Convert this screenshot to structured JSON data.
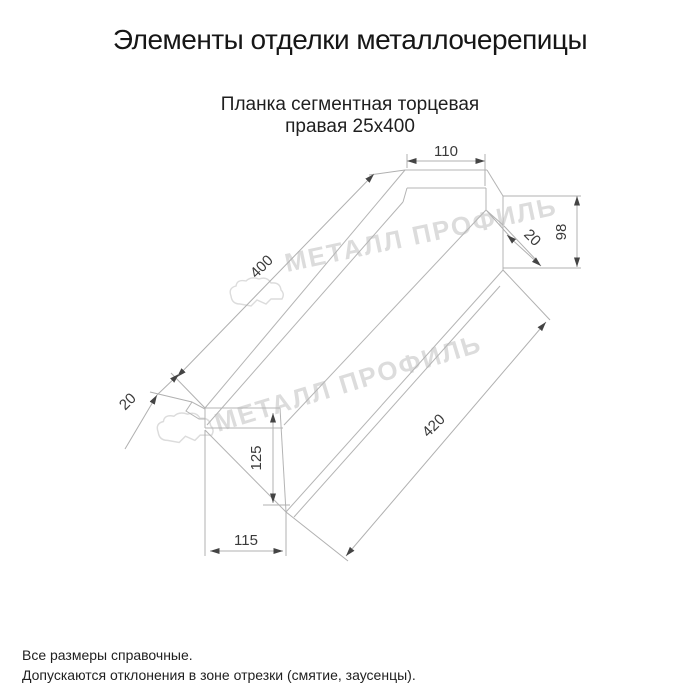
{
  "page": {
    "title": "Элементы отделки металлочерепицы"
  },
  "product": {
    "name_line1": "Планка сегментная торцевая",
    "name_line2": "правая 25х400"
  },
  "drawing": {
    "dimensions": {
      "top_flange_width": "110",
      "right_end_height": "98",
      "right_hem": "20",
      "top_edge_length": "400",
      "left_hem": "20",
      "left_end_height": "125",
      "left_end_width": "115",
      "bottom_edge_length": "420"
    },
    "watermark_text": "МЕТАЛЛ ПРОФИЛЬ",
    "colors": {
      "object_line": "#b4b4b4",
      "dimension_text": "#3a3a3a",
      "watermark": "#dcdcdc",
      "arrow": "#444444",
      "title_text": "#161616"
    }
  },
  "footer": {
    "note1": "Все размеры справочные.",
    "note2": "Допускаются отклонения в зоне отрезки (смятие, заусенцы)."
  }
}
